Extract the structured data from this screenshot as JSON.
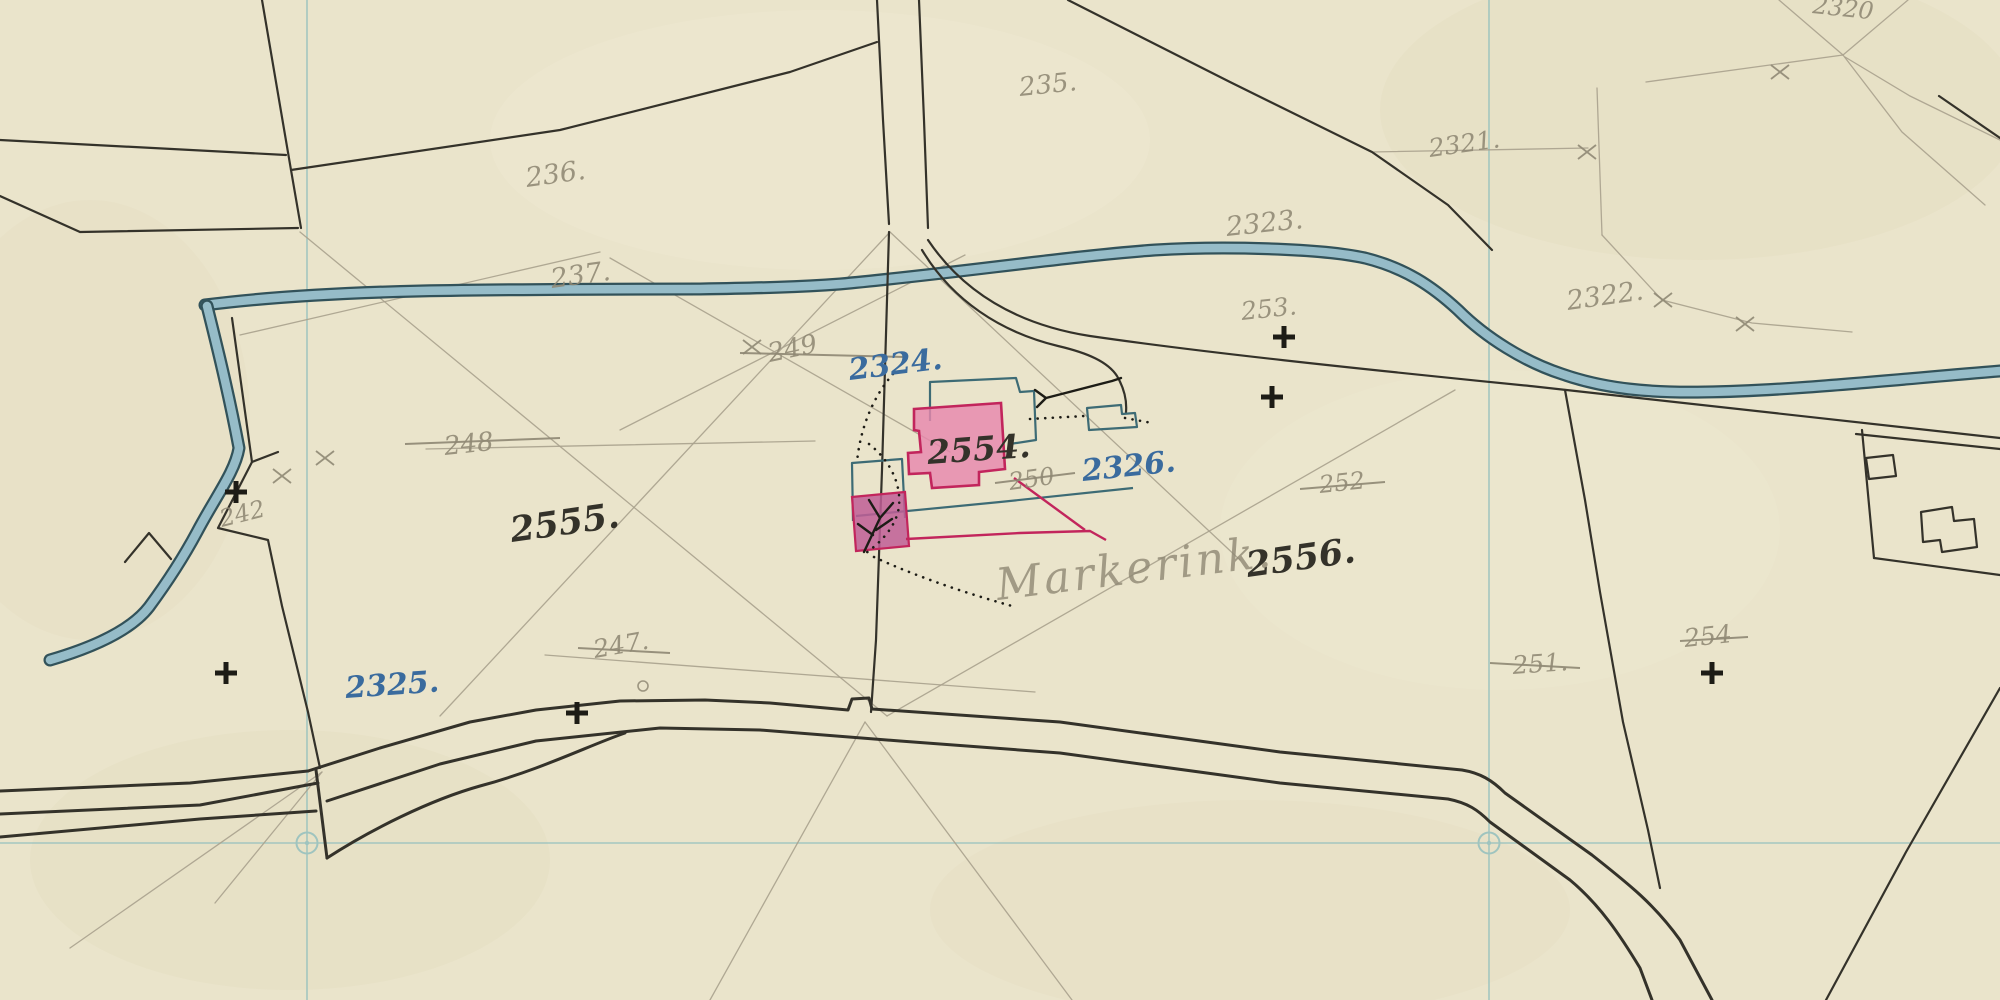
{
  "map": {
    "description": "Historical cadastral field sketch map",
    "palette": {
      "paper": "#eae4cb",
      "paper_shade": "#ded6b4",
      "paper_light": "#f2ecd8",
      "ink": "#34322a",
      "pencil": "#8f8874",
      "pencil_light": "#a8a18d",
      "blue_ink": "#3a6b9e",
      "red": "#c2255c",
      "pink_fill": "#e887ad",
      "pink_dark": "#c05e96",
      "teal": "#3d6b75",
      "stream_edge": "#32525a",
      "stream_fill": "#96bcc8",
      "grid": "#9fc4bf",
      "cross": "#1d1c16"
    },
    "labels": [
      {
        "text": "235.",
        "x": 1020,
        "y": 96,
        "size": 26,
        "rot": -6,
        "color": "pencil"
      },
      {
        "text": "236.",
        "x": 527,
        "y": 187,
        "size": 27,
        "rot": -8,
        "color": "pencil"
      },
      {
        "text": "237.",
        "x": 552,
        "y": 288,
        "size": 27,
        "rot": -8,
        "color": "pencil"
      },
      {
        "text": "2321.",
        "x": 1430,
        "y": 157,
        "size": 25,
        "rot": -8,
        "color": "pencil"
      },
      {
        "text": "2323.",
        "x": 1227,
        "y": 236,
        "size": 27,
        "rot": -6,
        "color": "pencil"
      },
      {
        "text": "2322.",
        "x": 1568,
        "y": 310,
        "size": 27,
        "rot": -8,
        "color": "pencil"
      },
      {
        "text": "253.",
        "x": 1242,
        "y": 320,
        "size": 25,
        "rot": -6,
        "color": "pencil"
      },
      {
        "text": "249",
        "x": 770,
        "y": 362,
        "size": 26,
        "rot": -12,
        "color": "pencil",
        "strike": [
          740,
          353,
          905,
          357
        ]
      },
      {
        "text": "248",
        "x": 445,
        "y": 455,
        "size": 26,
        "rot": -6,
        "color": "pencil",
        "strike": [
          405,
          444,
          560,
          438
        ]
      },
      {
        "text": "250",
        "x": 1010,
        "y": 490,
        "size": 24,
        "rot": -8,
        "color": "pencil",
        "strike": [
          995,
          483,
          1075,
          473
        ]
      },
      {
        "text": "252",
        "x": 1320,
        "y": 493,
        "size": 24,
        "rot": -6,
        "color": "pencil",
        "strike": [
          1300,
          489,
          1385,
          482
        ]
      },
      {
        "text": "242",
        "x": 222,
        "y": 527,
        "size": 24,
        "rot": -14,
        "color": "pencil"
      },
      {
        "text": "247.",
        "x": 595,
        "y": 658,
        "size": 25,
        "rot": -10,
        "color": "pencil",
        "strike": [
          578,
          648,
          670,
          653
        ]
      },
      {
        "text": "251.",
        "x": 1513,
        "y": 674,
        "size": 25,
        "rot": -4,
        "color": "pencil",
        "strike": [
          1490,
          663,
          1580,
          668
        ]
      },
      {
        "text": "254",
        "x": 1685,
        "y": 647,
        "size": 25,
        "rot": -6,
        "color": "pencil",
        "strike": [
          1680,
          641,
          1748,
          637
        ]
      },
      {
        "text": "2320",
        "x": 1812,
        "y": 13,
        "size": 24,
        "rot": 6,
        "color": "pencil"
      },
      {
        "text": "2324.",
        "x": 850,
        "y": 380,
        "size": 30,
        "rot": -7,
        "color": "blue",
        "bold": true
      },
      {
        "text": "2326.",
        "x": 1083,
        "y": 481,
        "size": 30,
        "rot": -6,
        "color": "blue",
        "bold": true
      },
      {
        "text": "2325.",
        "x": 346,
        "y": 698,
        "size": 30,
        "rot": -4,
        "color": "blue",
        "bold": true
      },
      {
        "text": "2554.",
        "x": 928,
        "y": 464,
        "size": 33,
        "rot": -4,
        "color": "black",
        "bold": true
      },
      {
        "text": "2555.",
        "x": 512,
        "y": 542,
        "size": 35,
        "rot": -8,
        "color": "black",
        "bold": true
      },
      {
        "text": "2556.",
        "x": 1248,
        "y": 577,
        "size": 35,
        "rot": -8,
        "color": "black",
        "bold": true
      }
    ],
    "handwriting": {
      "text": "Markerink.",
      "x": 998,
      "y": 600,
      "size": 44,
      "rot": -7,
      "color": "pencil"
    },
    "crosses": [
      [
        236,
        492
      ],
      [
        226,
        673
      ],
      [
        577,
        713
      ],
      [
        1284,
        337
      ],
      [
        1272,
        397
      ],
      [
        1712,
        673
      ]
    ],
    "x_marks": [
      [
        752,
        347
      ],
      [
        325,
        458
      ],
      [
        282,
        476
      ],
      [
        1587,
        152
      ],
      [
        1663,
        300
      ],
      [
        1745,
        324
      ],
      [
        1780,
        72
      ]
    ],
    "survey_circles": [
      [
        307,
        843
      ],
      [
        1489,
        843
      ]
    ],
    "point_circles": [
      [
        643,
        686
      ]
    ]
  }
}
